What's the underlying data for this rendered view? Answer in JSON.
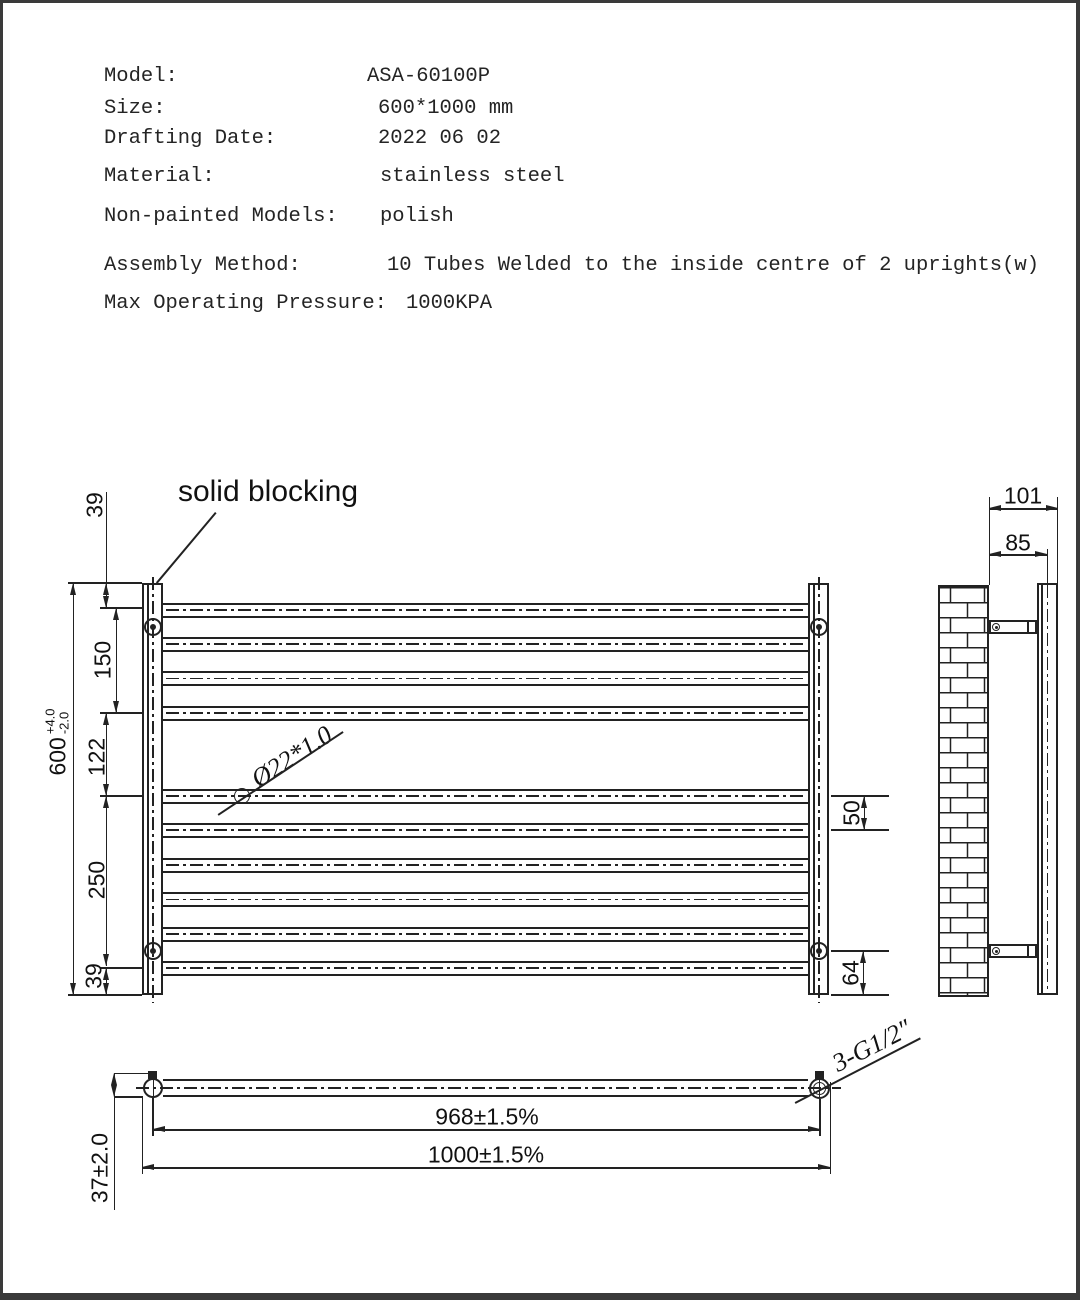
{
  "spec": {
    "rows": [
      {
        "label": "Model:",
        "value": "ASA-60100P"
      },
      {
        "label": "Size:",
        "value": "600*1000 mm"
      },
      {
        "label": "Drafting Date:",
        "value": "2022 06 02"
      },
      {
        "label": "Material:",
        "value": "stainless steel"
      },
      {
        "label": "Non-painted Models:",
        "value": "polish"
      },
      {
        "label": "Assembly Method:",
        "value": "10 Tubes Welded to the inside centre of 2 uprights(w)"
      },
      {
        "label": "Max Operating Pressure:",
        "value": "1000KPA"
      }
    ]
  },
  "front_view": {
    "solid_blocking_label": "solid blocking",
    "tube_spec_label": "Ø22*1.0",
    "dims": {
      "top_offset": "39",
      "upper_span": "150",
      "middle_gap": "122",
      "lower_span": "250",
      "bottom_offset": "39",
      "overall_height": "600",
      "tol_plus": "+4.0",
      "tol_minus": "-2.0",
      "tube_pitch": "50",
      "bottom_bracket": "64"
    }
  },
  "side_view": {
    "dims": {
      "depth_overall": "101",
      "depth_to_center": "85"
    }
  },
  "plan_view": {
    "connection_label": "3-G1/2″",
    "dims": {
      "tube_centres": "968±1.5%",
      "overall_width": "1000±1.5%",
      "depth": "37±2.0"
    }
  },
  "colors": {
    "line": "#222222",
    "frame": "#3a3a3a",
    "background": "#ffffff"
  }
}
